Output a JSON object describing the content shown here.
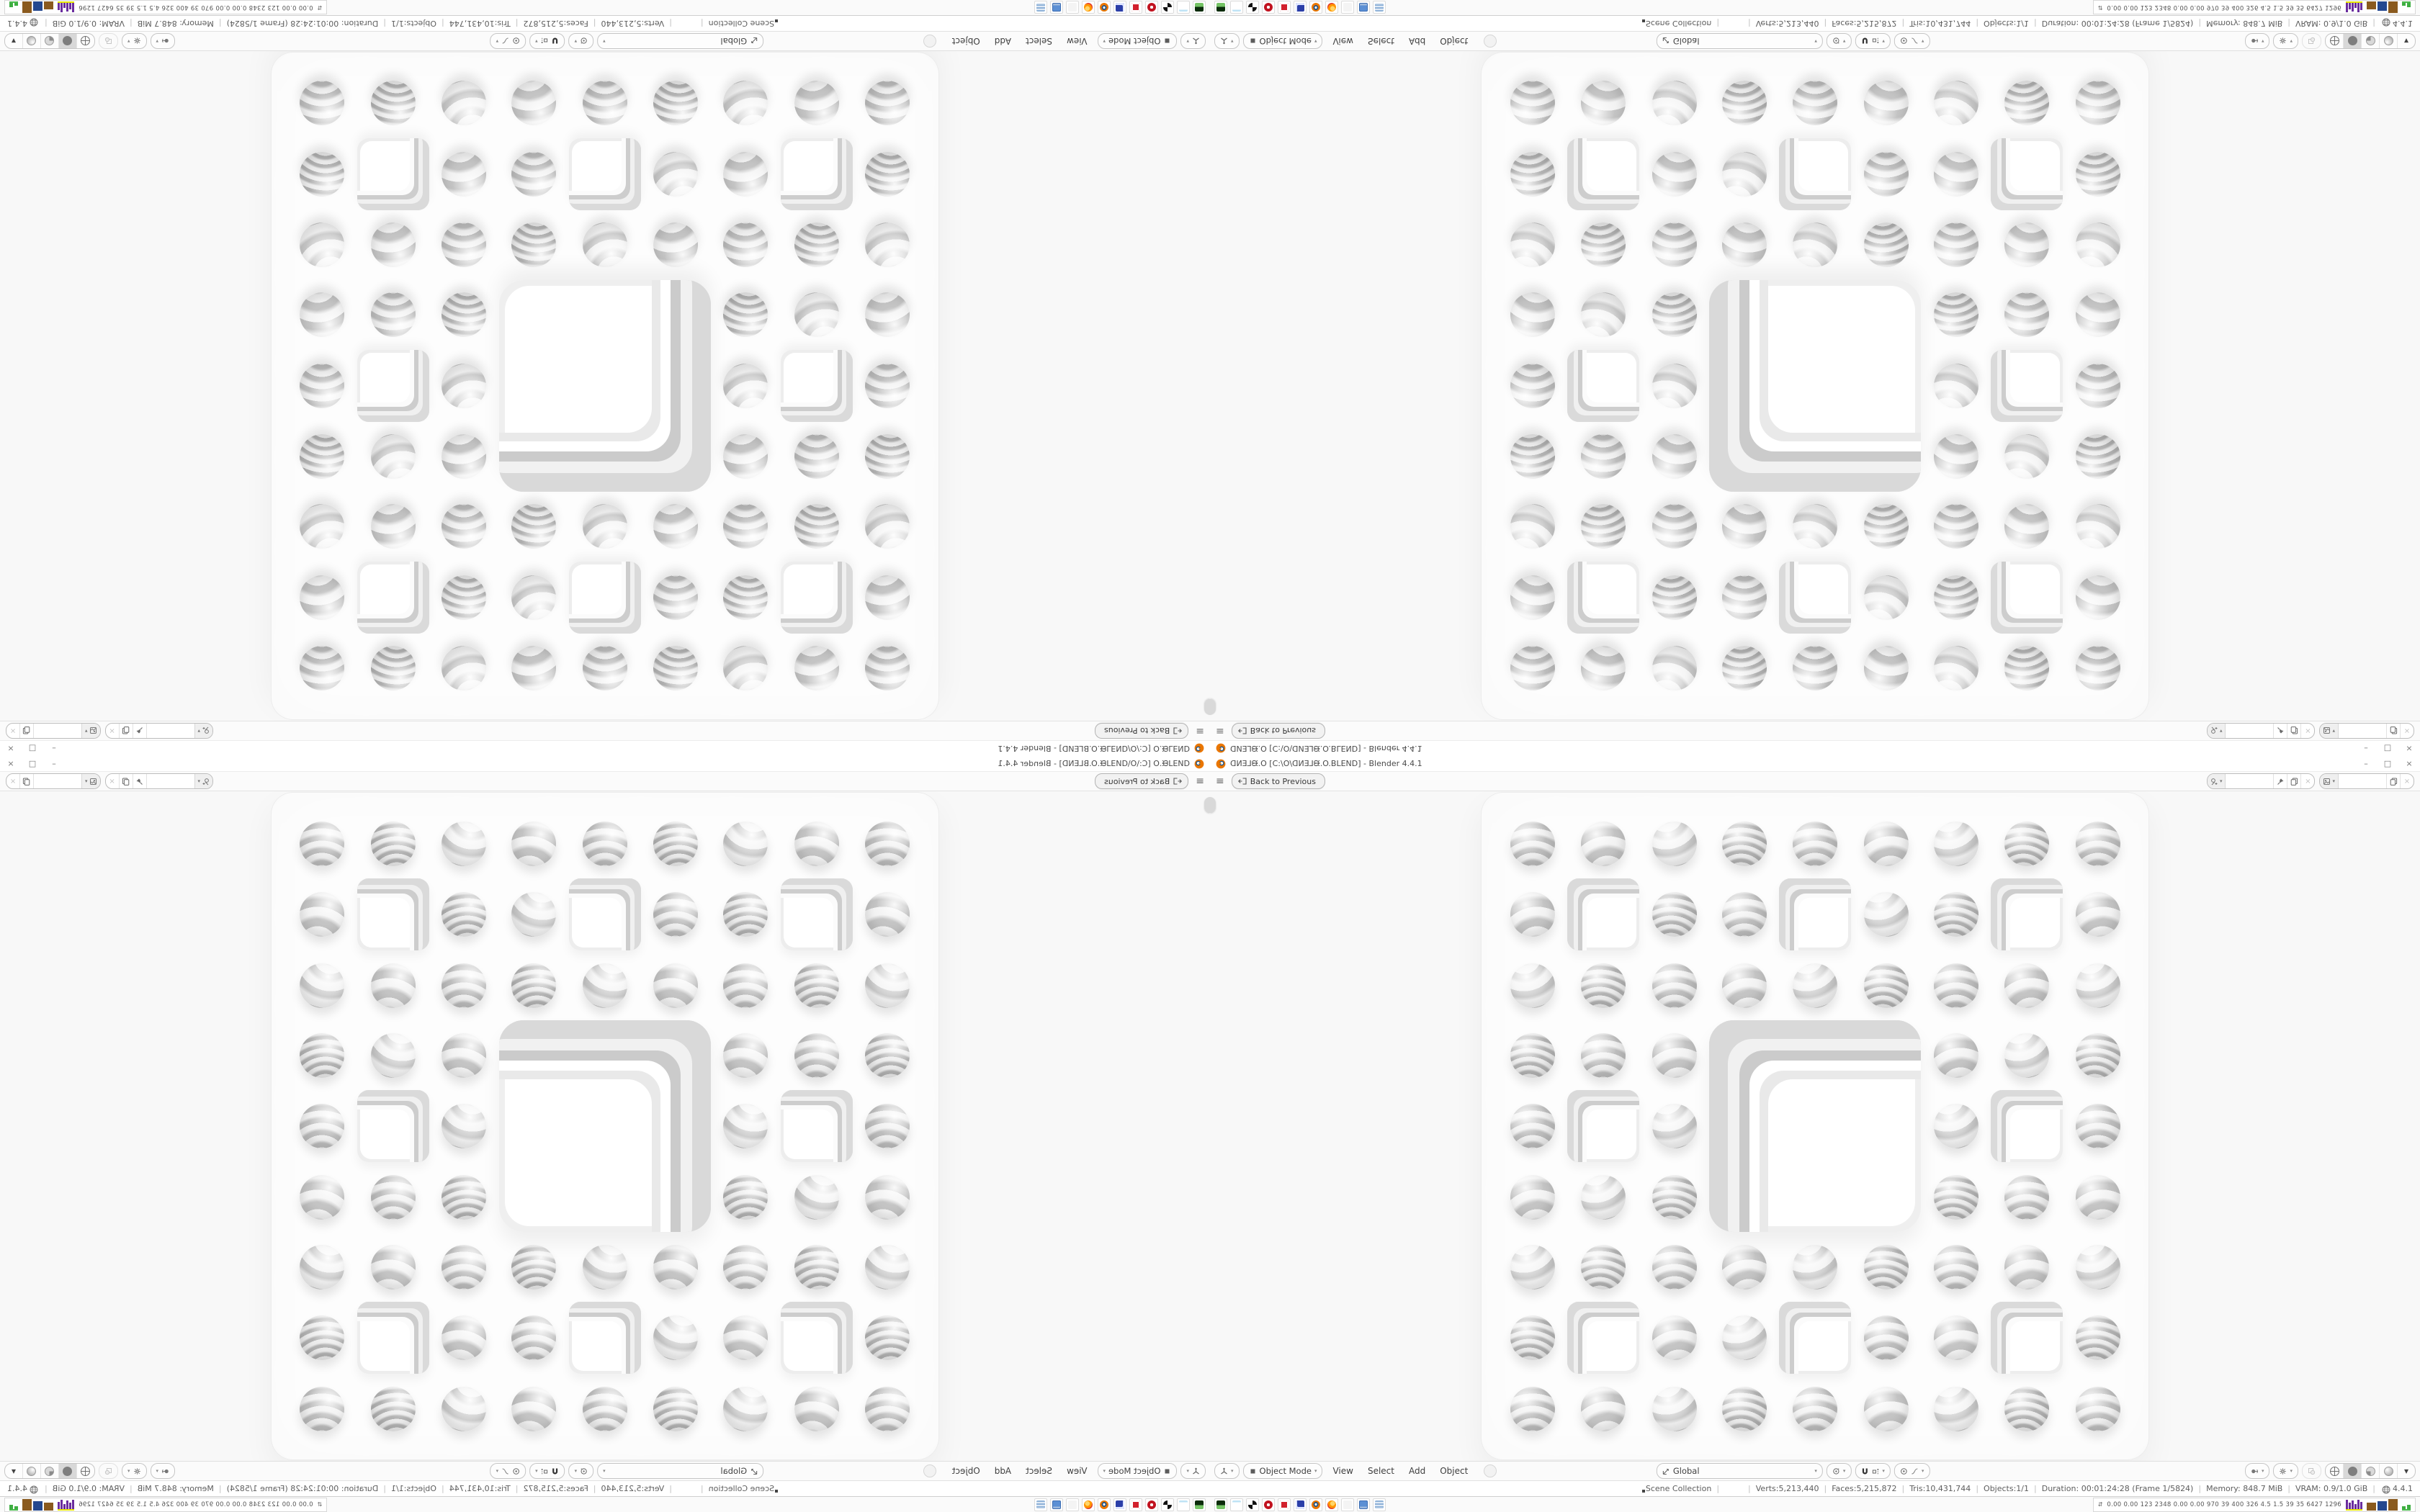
{
  "window": {
    "title": "ᗡИƎ⅃ᙠ.O [C:\\O\\ᗡИƎ⅃ᙠ.O.BLEND] - Blender 4.4.1",
    "controls": {
      "minimize": "–",
      "maximize": "□",
      "close": "×"
    }
  },
  "topbar": {
    "hamburger": "≡",
    "back_label": "Back to Previous",
    "scene_selector": {
      "value": ""
    },
    "view_layer_selector": {
      "value": ""
    }
  },
  "viewport_header": {
    "mode": "Object Mode",
    "menus": [
      "View",
      "Select",
      "Add",
      "Object"
    ],
    "orientation": "Global"
  },
  "status_bar": {
    "left": "Scene Collection",
    "stats": [
      "Verts:5,213,440",
      "Faces:5,215,872",
      "Tris:10,431,744",
      "Objects:1/1",
      "Duration: 00:01:24:28 (Frame 1/5824)",
      "Memory: 848.7 MiB",
      "VRAM: 0.9/1.0 GiB"
    ],
    "version": "4.4.1"
  },
  "taskbar": {
    "apps": [
      {
        "name": "media-player",
        "cls": "a-green"
      },
      {
        "name": "notepad",
        "cls": "a-note"
      },
      {
        "name": "photo-editor",
        "cls": "a-bw"
      },
      {
        "name": "red-app-1",
        "cls": "a-red1"
      },
      {
        "name": "red-app-2",
        "cls": "a-red2"
      },
      {
        "name": "emulator-64",
        "cls": "a-floppy"
      },
      {
        "name": "blender",
        "cls": "a-blender"
      },
      {
        "name": "firefox",
        "cls": "a-firefox"
      },
      {
        "name": "ghost-app",
        "cls": "a-ghost"
      },
      {
        "name": "display-settings",
        "cls": "a-display"
      },
      {
        "name": "calculator",
        "cls": "a-calc"
      }
    ],
    "sysmon_values": "0.00 0.00  123  2348 0.00 0.00  970   39   400  326   4.5   1.5   39   35  6427 1296"
  },
  "sponge": {
    "grid": 9,
    "small_holes": [
      [
        1,
        1
      ],
      [
        1,
        4
      ],
      [
        1,
        7
      ],
      [
        4,
        1
      ],
      [
        4,
        7
      ],
      [
        7,
        1
      ],
      [
        7,
        4
      ],
      [
        7,
        7
      ]
    ],
    "big_hole": {
      "row": 3,
      "col": 3,
      "span": 3
    }
  },
  "quadrants": [
    {
      "id": "tl",
      "transform": "rotate-180"
    },
    {
      "id": "tr",
      "transform": "flip-vertical"
    },
    {
      "id": "bl",
      "transform": "flip-horizontal"
    },
    {
      "id": "br",
      "transform": "none"
    }
  ],
  "colors": {
    "blender_orange": "#ea7600",
    "viewport_bg": "#f8f8f8",
    "bar_bg": "#fbfbfb",
    "sysmon_purple": "#6a2d9e",
    "sysmon_yellow": "#e8e800",
    "sysmon_brown": "#8a5a1e",
    "sysmon_blue": "#24488f",
    "sysmon_green": "#49b84c"
  }
}
